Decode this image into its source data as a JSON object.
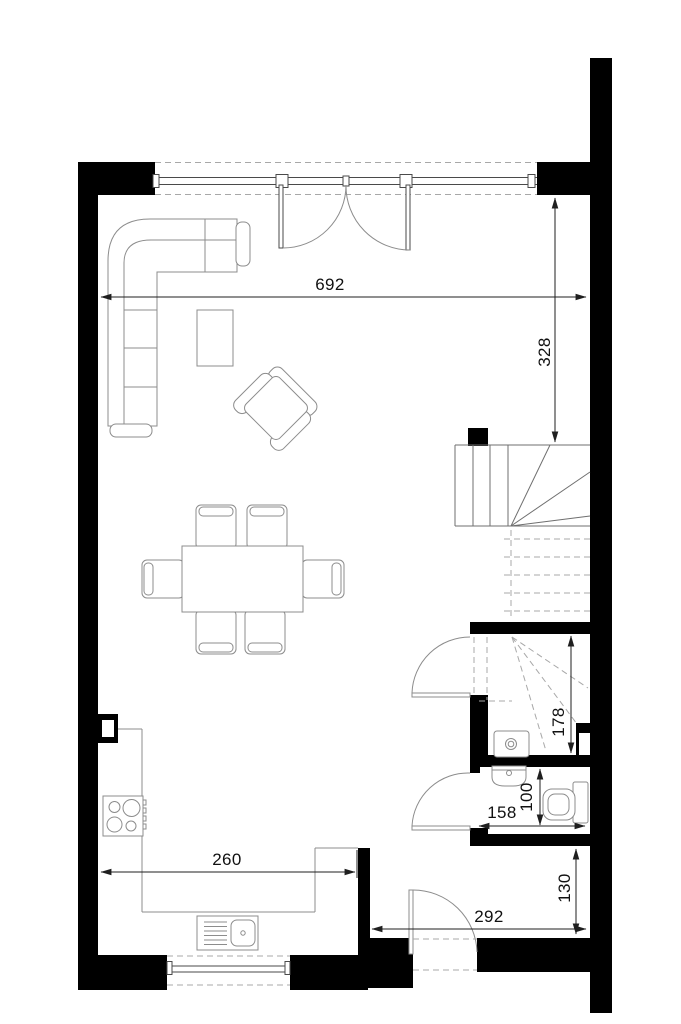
{
  "plan": {
    "dimensions": {
      "living_width": "692",
      "stair_offset": "328",
      "storage_depth": "178",
      "wc_depth": "100",
      "wc_width": "158",
      "entry_depth": "130",
      "entry_width": "292",
      "kitchen_width": "260"
    },
    "colors": {
      "wall": "#000000",
      "furniture_line": "#8c8c8c",
      "window_line": "#4a4a4a",
      "stair_line": "#6f6f6f",
      "dashed": "#a8a8a8",
      "dim_line": "#1f1f1f"
    }
  }
}
